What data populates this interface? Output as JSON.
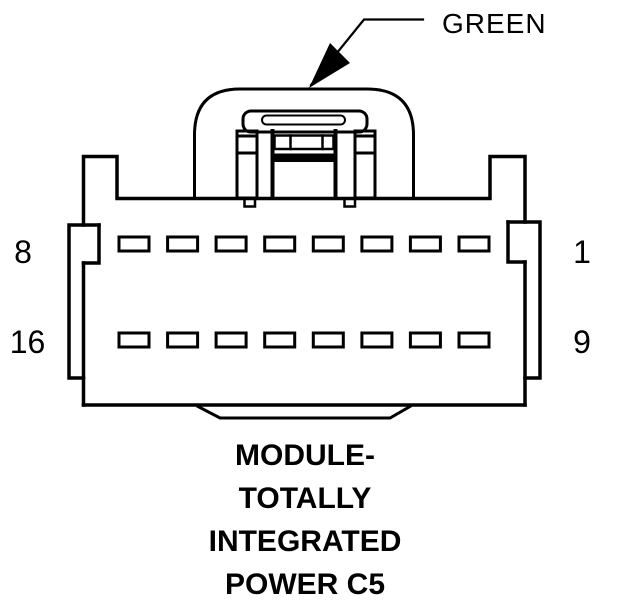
{
  "annotation": {
    "wire_color": "GREEN"
  },
  "connector": {
    "view": "front-face",
    "pin_rows": [
      {
        "left_label": "8",
        "right_label": "1",
        "pin_count": 8
      },
      {
        "left_label": "16",
        "right_label": "9",
        "pin_count": 8
      }
    ]
  },
  "title": {
    "lines": [
      "MODULE-",
      "TOTALLY",
      "INTEGRATED",
      "POWER C5"
    ]
  },
  "colors": {
    "line": "#000000",
    "background": "#ffffff"
  }
}
